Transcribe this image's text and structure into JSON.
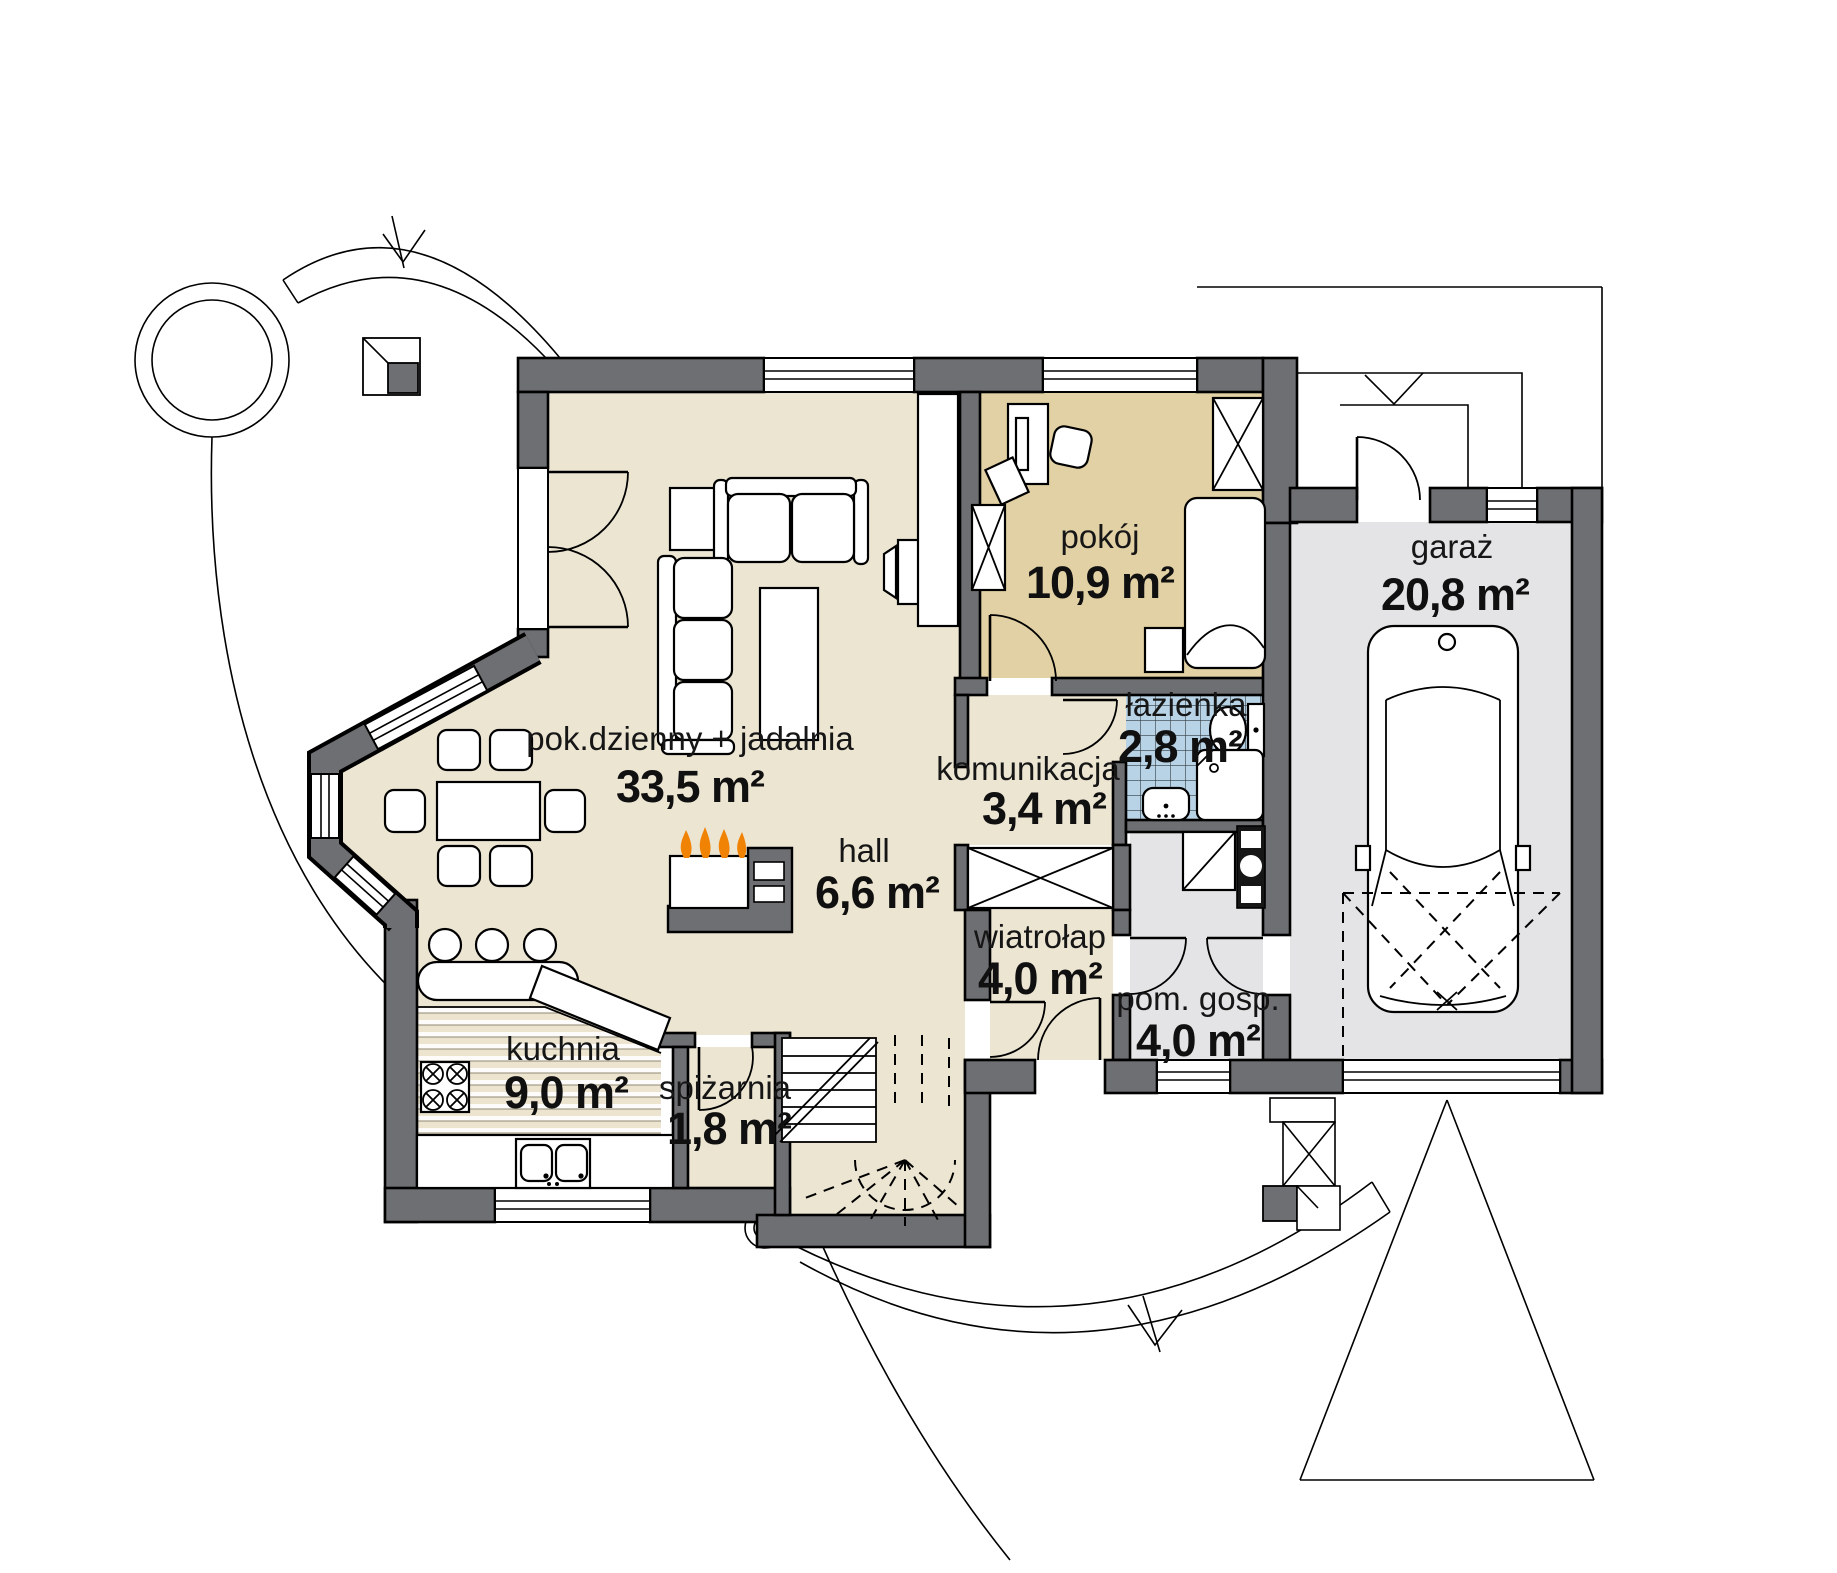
{
  "plan": {
    "rooms": [
      {
        "id": "pok-dzienny",
        "name": "pok.dzienny + jadalnia",
        "area": "33,5 m²"
      },
      {
        "id": "pokoj",
        "name": "pokój",
        "area": "10,9 m²"
      },
      {
        "id": "garaz",
        "name": "garaż",
        "area": "20,8 m²"
      },
      {
        "id": "lazienka",
        "name": "łazienka",
        "area": "2,8 m²"
      },
      {
        "id": "komunikacja",
        "name": "komunikacja",
        "area": "3,4 m²"
      },
      {
        "id": "hall",
        "name": "hall",
        "area": "6,6 m²"
      },
      {
        "id": "wiatrolap",
        "name": "wiatrołap",
        "area": "4,0 m²"
      },
      {
        "id": "pom-gosp",
        "name": "pom. gosp.",
        "area": "4,0 m²"
      },
      {
        "id": "kuchnia",
        "name": "kuchnia",
        "area": "9,0 m²"
      },
      {
        "id": "spizarnia",
        "name": "spiżarnia",
        "area": "1,8 m²"
      }
    ],
    "colors": {
      "wall": "#6e6f72",
      "floor": "#ece5d2",
      "floor_room": "#e2d1a5",
      "bath": "#b9d3e6",
      "garage": "#e4e4e6",
      "flame": "#f08204"
    }
  }
}
